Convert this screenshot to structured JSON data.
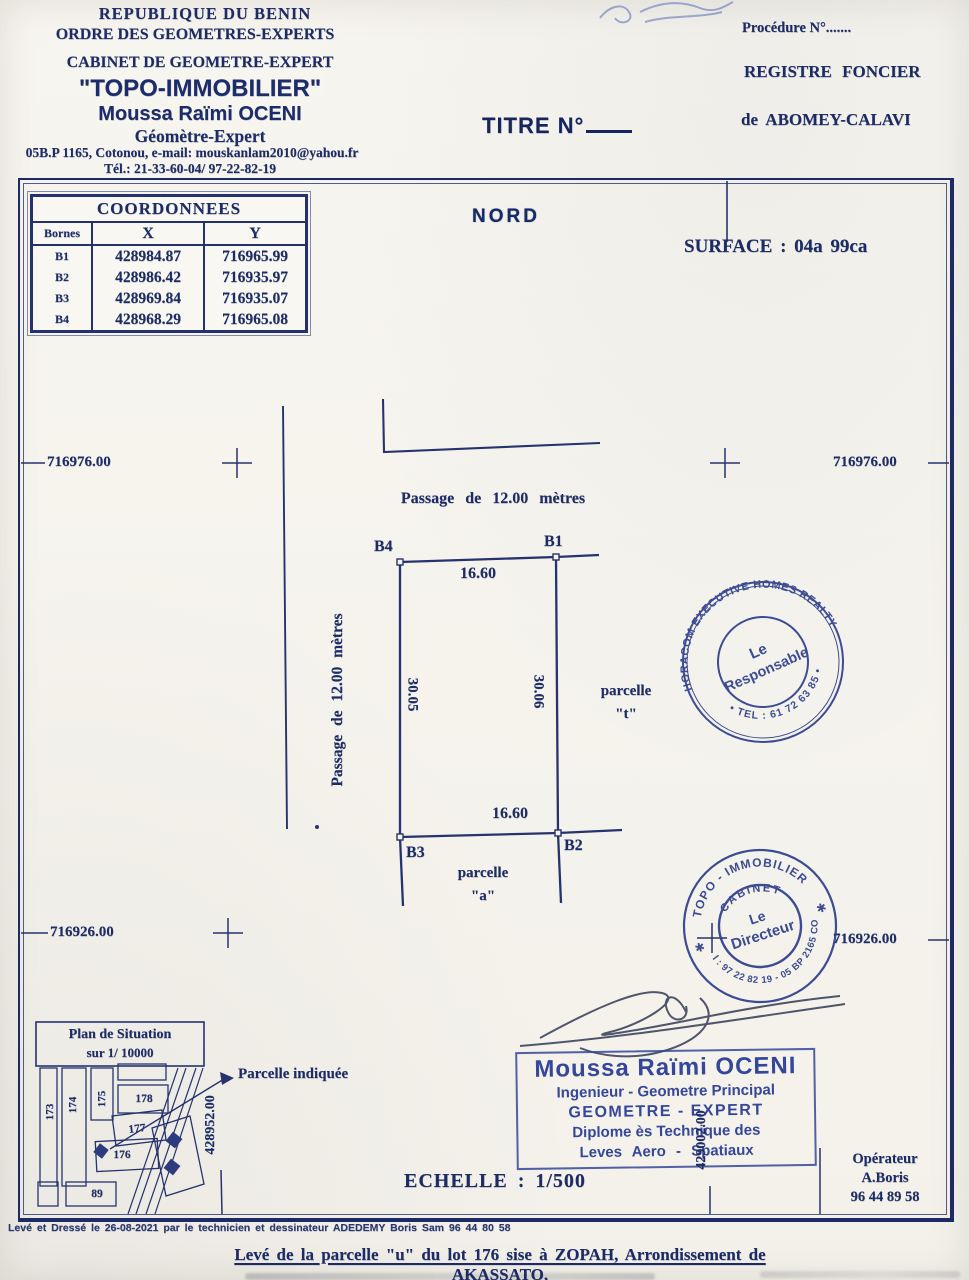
{
  "header": {
    "left": {
      "line1": "REPUBLIQUE DU BENIN",
      "line2": "ORDRE DES GEOMETRES-EXPERTS",
      "line3": "CABINET DE GEOMETRE-EXPERT",
      "firm": "\"TOPO-IMMOBILIER\"",
      "name": "Moussa Raïmi OCENI",
      "role": "Géomètre-Expert",
      "address": "05B.P 1165, Cotonou, e-mail: mouskanlam2010@yahou.fr",
      "phone": "Tél.: 21-33-60-04/ 97-22-82-19"
    },
    "center": {
      "titre": "TITRE N°"
    },
    "right": {
      "procedure": "Procédure N°.......",
      "registre": "REGISTRE FONCIER",
      "location": "de ABOMEY-CALAVI"
    }
  },
  "coordinates_table": {
    "title": "COORDONNEES",
    "columns": [
      "Bornes",
      "X",
      "Y"
    ],
    "rows": [
      [
        "B1",
        "428984.87",
        "716965.99"
      ],
      [
        "B2",
        "428986.42",
        "716935.97"
      ],
      [
        "B3",
        "428969.84",
        "716935.07"
      ],
      [
        "B4",
        "428968.29",
        "716965.08"
      ]
    ]
  },
  "plan": {
    "north_label": "NORD",
    "surface_label": "SURFACE : 04a 99ca",
    "passage_horizontal": "Passage de 12.00 mètres",
    "passage_vertical": "Passage de 12.00 mètres",
    "b1": "B1",
    "b2": "B2",
    "b3": "B3",
    "b4": "B4",
    "dim_top": "16.60",
    "dim_bottom": "16.60",
    "dim_left": "30.05",
    "dim_right": "30.06",
    "parcelle_t_word": "parcelle",
    "parcelle_t_id": "\"t\"",
    "parcelle_a_word": "parcelle",
    "parcelle_a_id": "\"a\"",
    "scale_label": "ECHELLE : 1/500"
  },
  "grid": {
    "north_y": "716976.00",
    "south_y": "716926.00",
    "west_x": "428952.00",
    "east_x": "429002.00"
  },
  "stamps": {
    "horacom": {
      "arc_top": "HORACOM EXECUTIVE HOMES REALTY",
      "arc_bottom": "• TEL : 61 72 63 85 •",
      "center_line1": "Le",
      "center_line2": "Responsable"
    },
    "topo": {
      "arc_top": "TOPO - IMMOBILIER",
      "arc_mid": "CABINET",
      "arc_bottom": "Tel : 97 22 82 19 - 05 BP 2165 COT",
      "star": "✱",
      "center_line1": "Le",
      "center_line2": "Directeur"
    },
    "expert_box": {
      "line1": "Moussa Raïmi OCENI",
      "line2": "Ingenieur - Geometre Principal",
      "line3": "GEOMETRE - EXPERT",
      "line4": "Diplome ès Technique des",
      "line5": "Leves Aero - Spatiaux"
    }
  },
  "situation": {
    "title_line1": "Plan de Situation",
    "title_line2": "sur 1/ 10000",
    "lots": [
      "173",
      "174",
      "175",
      "178",
      "177",
      "176",
      "89"
    ],
    "callout": "Parcelle indiquée"
  },
  "operator": {
    "label": "Opérateur",
    "name": "A.Boris",
    "phone": "96 44 89 58"
  },
  "footer": {
    "note": "Levé et Dressé le 26-08-2021 par le technicien et dessinateur ADEDEMY Boris Sam 96 44 80 58",
    "title": "Levé de la parcelle \"u\" du lot 176 sise à ZOPAH, Arrondissement de AKASSATO,"
  }
}
